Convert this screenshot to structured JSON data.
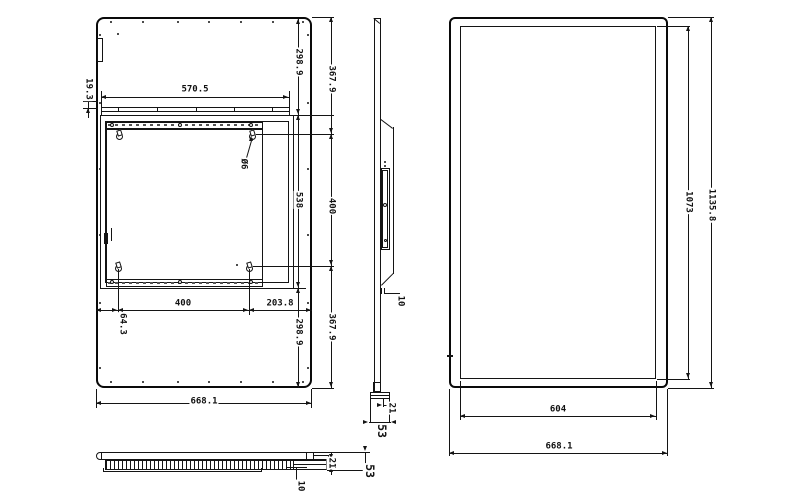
{
  "back_view": {
    "rail_width": "570.5",
    "side_offset": "19.3",
    "top_margin": "298.9",
    "vesa_top_offset": "367.9",
    "bracket_height": "538",
    "vesa_vertical_pitch": "400",
    "hole_diameter": "Ø6",
    "vesa_horizontal_pitch": "400",
    "hole_to_right_edge": "203.8",
    "hole_to_left_edge": "64.3",
    "bottom_margin": "298.9",
    "vesa_bottom_offset": "367.9",
    "overall_width": "668.1"
  },
  "side_view": {
    "step_depth": "10",
    "mount_depth": "21",
    "overall_depth": "53"
  },
  "front_view": {
    "display_height": "1073",
    "overall_height": "1135.8",
    "display_width": "604",
    "overall_width": "668.1"
  },
  "bottom_view": {
    "grille_depth": "10",
    "step_depth": "21",
    "overall_depth": "53"
  },
  "colors": {
    "line": "#141414",
    "background": "#ffffff"
  }
}
